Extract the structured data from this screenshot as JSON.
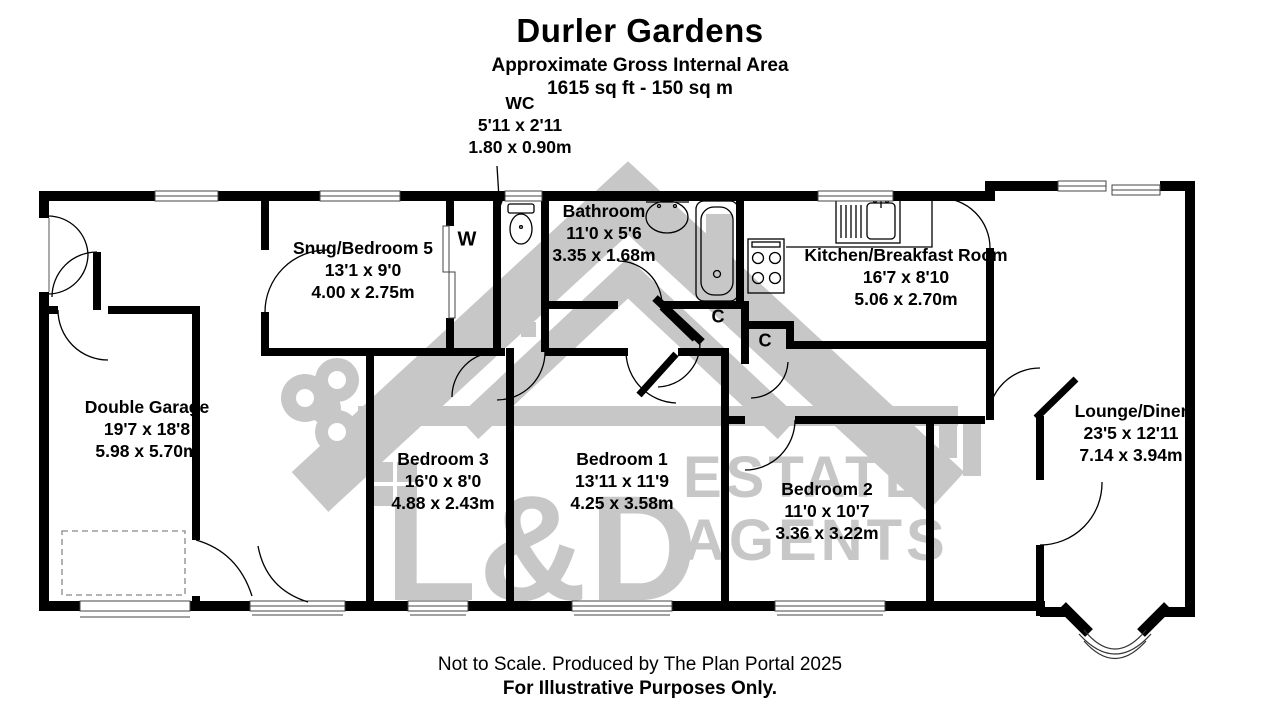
{
  "title": {
    "name": "Durler Gardens",
    "subtitle": "Approximate Gross Internal Area",
    "area": "1615 sq ft - 150 sq m"
  },
  "rooms": {
    "wc": {
      "name": "WC",
      "imperial": "5'11 x 2'11",
      "metric": "1.80 x 0.90m"
    },
    "snug": {
      "name": "Snug/Bedroom 5",
      "imperial": "13'1 x 9'0",
      "metric": "4.00 x 2.75m"
    },
    "bathroom": {
      "name": "Bathroom",
      "imperial": "11'0 x 5'6",
      "metric": "3.35 x 1.68m"
    },
    "kitchen": {
      "name": "Kitchen/Breakfast Room",
      "imperial": "16'7 x 8'10",
      "metric": "5.06 x 2.70m"
    },
    "garage": {
      "name": "Double Garage",
      "imperial": "19'7 x 18'8",
      "metric": "5.98 x 5.70m"
    },
    "bedroom3": {
      "name": "Bedroom 3",
      "imperial": "16'0 x 8'0",
      "metric": "4.88 x 2.43m"
    },
    "bedroom1": {
      "name": "Bedroom 1",
      "imperial": "13'11 x 11'9",
      "metric": "4.25 x 3.58m"
    },
    "bedroom2": {
      "name": "Bedroom 2",
      "imperial": "11'0 x 10'7",
      "metric": "3.36 x 3.22m"
    },
    "lounge": {
      "name": "Lounge/Diner",
      "imperial": "23'5 x 12'11",
      "metric": "7.14 x 3.94m"
    }
  },
  "markers": {
    "wardrobe": "W",
    "cupboard1": "C",
    "cupboard2": "C"
  },
  "watermark": {
    "line1": "L&D",
    "line2": "ESTATE",
    "line3": "AGENTS"
  },
  "footer": {
    "line1": "Not to Scale. Produced by The Plan Portal 2025",
    "line2": "For Illustrative Purposes Only."
  },
  "colors": {
    "wall": "#000000",
    "watermark": "#c7c7c7",
    "background": "#ffffff"
  }
}
